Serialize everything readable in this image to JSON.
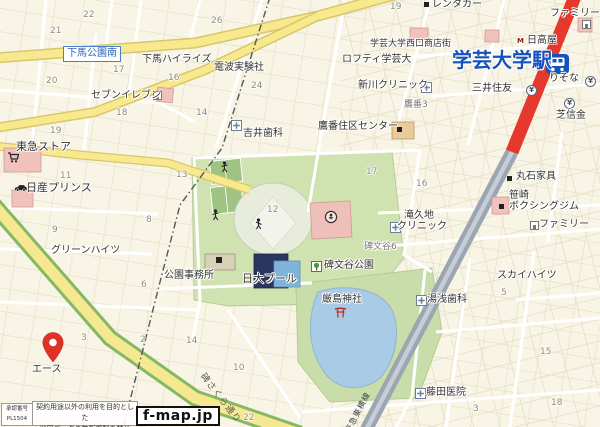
{
  "map": {
    "sign": "下馬公園南",
    "station": {
      "name": "学芸大学駅"
    },
    "railway_label": "東急東横線",
    "road_label": "碑さくら通り",
    "watermark": {
      "logo": "f-map.jp",
      "license1": "承認番号",
      "license2": "PL1504",
      "notice1": "契約用途以外の利用を目的とした",
      "notice2": "地図データの無断複製を禁じる。"
    },
    "colors": {
      "station_blue": "#1552bd",
      "railway_red": "#e6392e",
      "railway_gray": "#9ba6b2",
      "road_yellow": "#f8e98f",
      "park_green": "#cfe2b0",
      "water_blue": "#a9cbe6",
      "pin_red": "#e03127",
      "building_pink": "#f1c2bc"
    },
    "labels": [
      {
        "text": "下馬ハイライズ",
        "x": 142,
        "y": 55
      },
      {
        "text": "電波実験社",
        "x": 214,
        "y": 63
      },
      {
        "text": "セブンイレブン",
        "x": 91,
        "y": 91
      },
      {
        "text": "吉井歯科",
        "x": 243,
        "y": 129
      },
      {
        "text": "東急ストア",
        "x": 16,
        "y": 141,
        "size": 11
      },
      {
        "text": "日産プリンス",
        "x": 26,
        "y": 182,
        "size": 11
      },
      {
        "text": "グリーンハイツ",
        "x": 51,
        "y": 246
      },
      {
        "text": "公園事務所",
        "x": 164,
        "y": 271
      },
      {
        "text": "日大プール",
        "x": 242,
        "y": 273,
        "size": 11
      },
      {
        "text": "碑文谷公園",
        "x": 324,
        "y": 261
      },
      {
        "text": "厳島神社",
        "x": 322,
        "y": 295
      },
      {
        "text": "碑文谷6",
        "x": 364,
        "y": 243,
        "size": 9,
        "color": "#777"
      },
      {
        "text": "鷹番3",
        "x": 404,
        "y": 101,
        "size": 9,
        "color": "#777"
      },
      {
        "text": "滝久地",
        "x": 404,
        "y": 211
      },
      {
        "text": "クリニック",
        "x": 397,
        "y": 222
      },
      {
        "text": "新川クリニック",
        "x": 358,
        "y": 81
      },
      {
        "text": "学芸大学西口商店街",
        "x": 370,
        "y": 40,
        "size": 9
      },
      {
        "text": "ロフティ学芸大",
        "x": 342,
        "y": 55
      },
      {
        "text": "レンタカー",
        "x": 432,
        "y": 0
      },
      {
        "text": "ファミリー",
        "x": 550,
        "y": 9
      },
      {
        "text": "日高屋",
        "x": 527,
        "y": 36
      },
      {
        "text": "学芸大学駅",
        "x": 452,
        "y": 50,
        "size": 20,
        "bold": true,
        "color": "#1552bd"
      },
      {
        "text": "三井住友",
        "x": 472,
        "y": 84
      },
      {
        "text": "りそな",
        "x": 549,
        "y": 74
      },
      {
        "text": "芝信金",
        "x": 556,
        "y": 111
      },
      {
        "text": "丸石家具",
        "x": 516,
        "y": 172
      },
      {
        "text": "笹崎",
        "x": 509,
        "y": 191
      },
      {
        "text": "ボクシングジム",
        "x": 509,
        "y": 202
      },
      {
        "text": "ファミリー",
        "x": 539,
        "y": 220
      },
      {
        "text": "スカイハイツ",
        "x": 497,
        "y": 271
      },
      {
        "text": "湯浅歯科",
        "x": 427,
        "y": 295
      },
      {
        "text": "藤田医院",
        "x": 426,
        "y": 388
      },
      {
        "text": "エース",
        "x": 32,
        "y": 365
      },
      {
        "text": "鷹番住区センター",
        "x": 318,
        "y": 122
      }
    ],
    "numbers": [
      {
        "n": "21",
        "x": 50,
        "y": 26
      },
      {
        "n": "22",
        "x": 83,
        "y": 10
      },
      {
        "n": "26",
        "x": 211,
        "y": 16
      },
      {
        "n": "17",
        "x": 113,
        "y": 65
      },
      {
        "n": "16",
        "x": 168,
        "y": 73
      },
      {
        "n": "20",
        "x": 46,
        "y": 76
      },
      {
        "n": "24",
        "x": 251,
        "y": 81
      },
      {
        "n": "18",
        "x": 116,
        "y": 108
      },
      {
        "n": "14",
        "x": 196,
        "y": 108
      },
      {
        "n": "19",
        "x": 50,
        "y": 126
      },
      {
        "n": "19",
        "x": 390,
        "y": 2
      },
      {
        "n": "13",
        "x": 176,
        "y": 170
      },
      {
        "n": "11",
        "x": 60,
        "y": 171
      },
      {
        "n": "9",
        "x": 52,
        "y": 225
      },
      {
        "n": "8",
        "x": 146,
        "y": 215
      },
      {
        "n": "12",
        "x": 267,
        "y": 205
      },
      {
        "n": "16",
        "x": 416,
        "y": 179
      },
      {
        "n": "17",
        "x": 366,
        "y": 167
      },
      {
        "n": "6",
        "x": 141,
        "y": 280
      },
      {
        "n": "3",
        "x": 81,
        "y": 333
      },
      {
        "n": "2",
        "x": 140,
        "y": 335
      },
      {
        "n": "14",
        "x": 186,
        "y": 336
      },
      {
        "n": "10",
        "x": 233,
        "y": 363
      },
      {
        "n": "28",
        "x": 104,
        "y": 401
      },
      {
        "n": "22",
        "x": 243,
        "y": 413
      },
      {
        "n": "15",
        "x": 540,
        "y": 347
      },
      {
        "n": "18",
        "x": 551,
        "y": 398
      },
      {
        "n": "5",
        "x": 501,
        "y": 288
      },
      {
        "n": "3",
        "x": 473,
        "y": 404
      }
    ]
  }
}
